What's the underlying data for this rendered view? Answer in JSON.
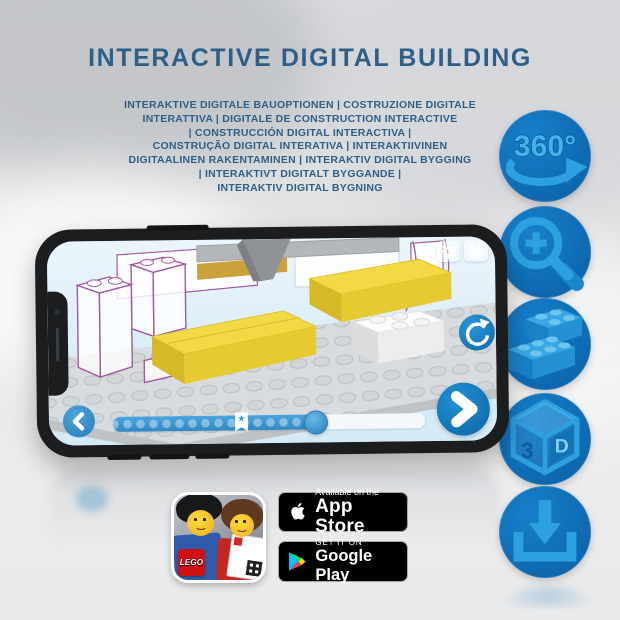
{
  "header": {
    "title": "INTERACTIVE DIGITAL BUILDING",
    "subtitle_lines": [
      "INTERAKTIVE DIGITALE BAUOPTIONEN | COSTRUZIONE DIGITALE",
      "INTERATTIVA | DIGITALE DE CONSTRUCTION INTERACTIVE",
      "| CONSTRUCCIÓN DIGITAL INTERACTIVA |",
      "CONSTRUÇÃO DIGITAL INTERATIVA | INTERAKTIIVINEN",
      "DIGITAALINEN RAKENTAMINEN | INTERAKTIV DIGITAL BYGGING",
      "| INTERAKTIVT DIGITALT BYGGANDE |",
      "INTERAKTIV DIGITAL BYGNING"
    ]
  },
  "features": {
    "rotate_360_label": "360°",
    "cube_face_left": "3",
    "cube_face_right": "D",
    "icon_names": [
      "360-rotation-icon",
      "zoom-in-icon",
      "bricks-icon",
      "3d-cube-icon",
      "download-icon"
    ]
  },
  "phone": {
    "marker_star": "★"
  },
  "store": {
    "app_icon_logo": "LEGO",
    "app_store": {
      "tagline": "Available on the",
      "name": "App Store"
    },
    "google_play": {
      "tagline": "GET IT ON",
      "name": "Google Play"
    }
  },
  "colors": {
    "heading_blue": "#2e5f88",
    "circle_blue": "#0d67ae",
    "glyph_blue": "#2da0e0",
    "bar_blue": "#3d98d4",
    "brick_yellow": "#f3da45",
    "ghost_outline_purple": "#a05aa3",
    "screen_sky": "#ddeef8"
  }
}
